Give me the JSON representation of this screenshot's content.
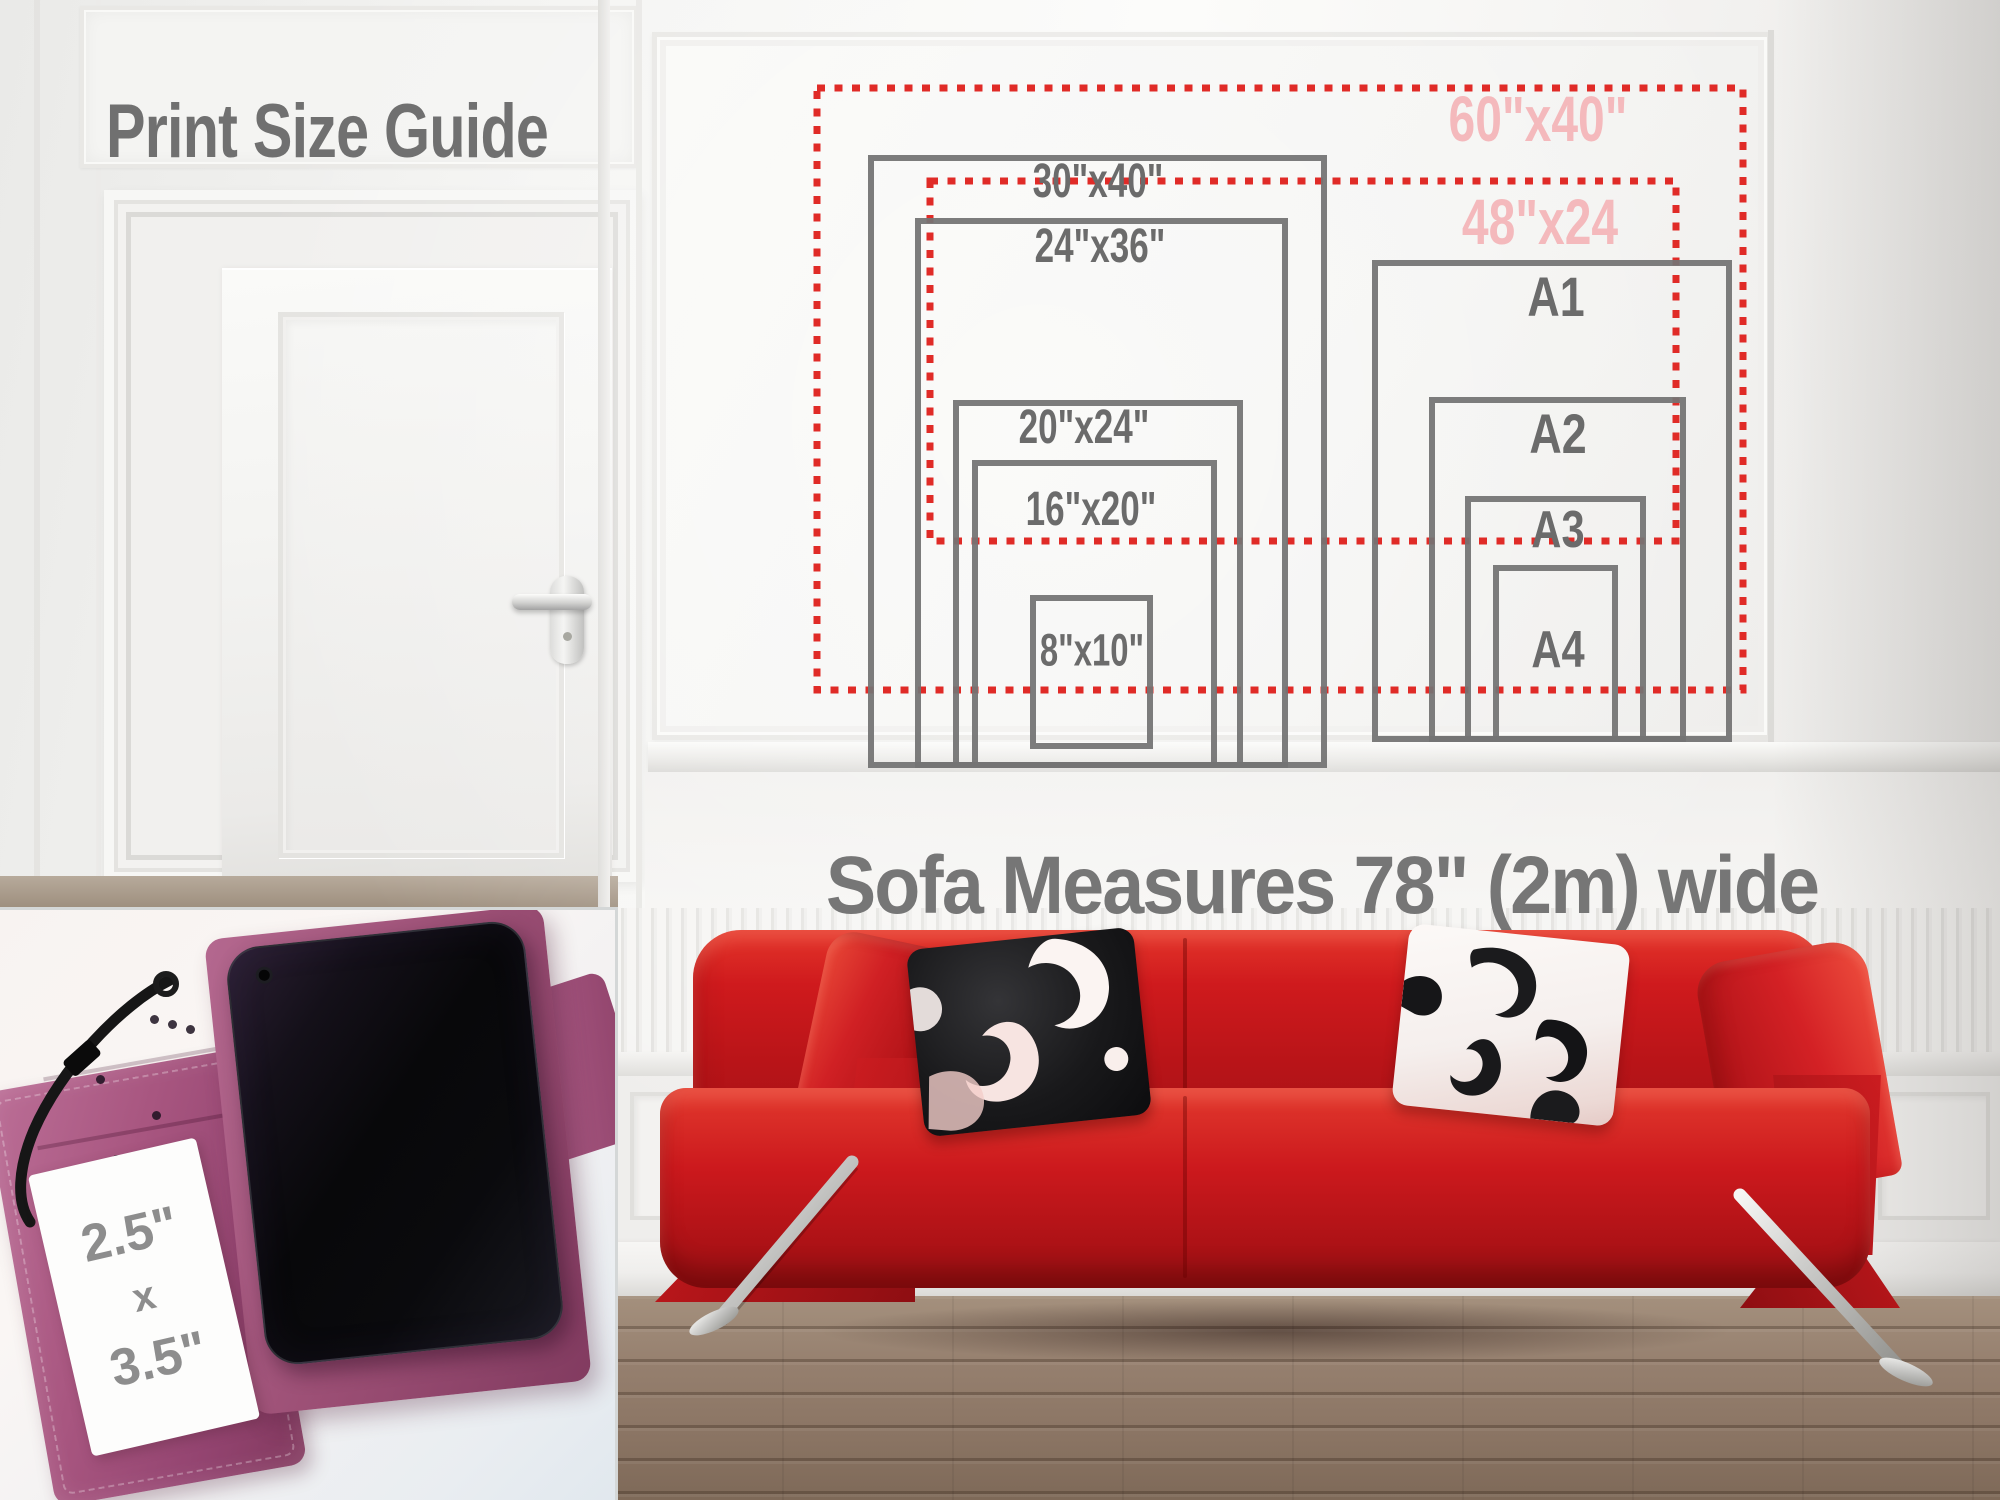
{
  "title": "Print Size Guide",
  "caption": "Sofa Measures 78\" (2m) wide",
  "size_guide": {
    "imperial_prints": [
      {
        "label": "30\"x40\""
      },
      {
        "label": "24\"x36\""
      },
      {
        "label": "20\"x24\""
      },
      {
        "label": "16\"x20\""
      },
      {
        "label": "8\"x10\""
      }
    ],
    "a_series_prints": [
      {
        "label": "A1"
      },
      {
        "label": "A2"
      },
      {
        "label": "A3"
      },
      {
        "label": "A4"
      }
    ],
    "oversize_prints": [
      {
        "label": "60\"x40\""
      },
      {
        "label": "48\"x24"
      }
    ]
  },
  "phone_case_inset": {
    "width_label": "2.5\"",
    "separator": "x",
    "height_label": "3.5\""
  },
  "colors": {
    "label_gray": "#6b6b6b",
    "outline_gray": "#747474",
    "dotted_red": "#e02b27",
    "oversize_pink": "#f4b9bc",
    "sofa_red": "#c21418",
    "case_magenta": "#a85680",
    "floor_wood": "#8f7a69"
  }
}
